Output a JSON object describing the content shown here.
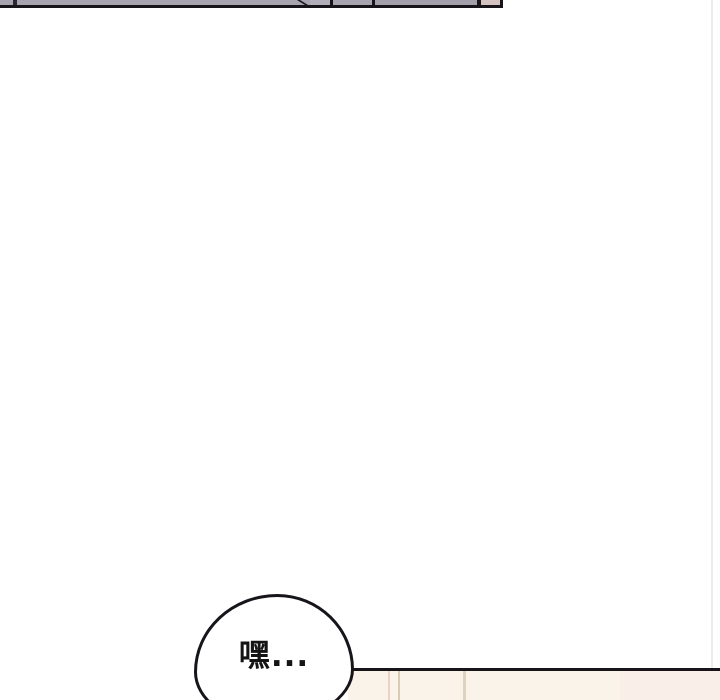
{
  "comic_page": {
    "background_color": "#ffffff",
    "speech_bubble": {
      "text": "嘿...",
      "fill_color": "#ffffff",
      "outline_color": "#17141a",
      "text_color": "#141414"
    },
    "top_panel_fragment": {
      "fill_color": "#a7a4b0",
      "accent_fill_color": "#d3c2c0",
      "outline_color": "#17141a"
    },
    "next_panel_fragment": {
      "fill_color": "#faf3e9",
      "outline_color": "#17141a",
      "background_edge_colors": [
        "#ecd2c3",
        "#d8ccb5",
        "#ded4bd"
      ]
    },
    "seam_color": "#ededed"
  }
}
